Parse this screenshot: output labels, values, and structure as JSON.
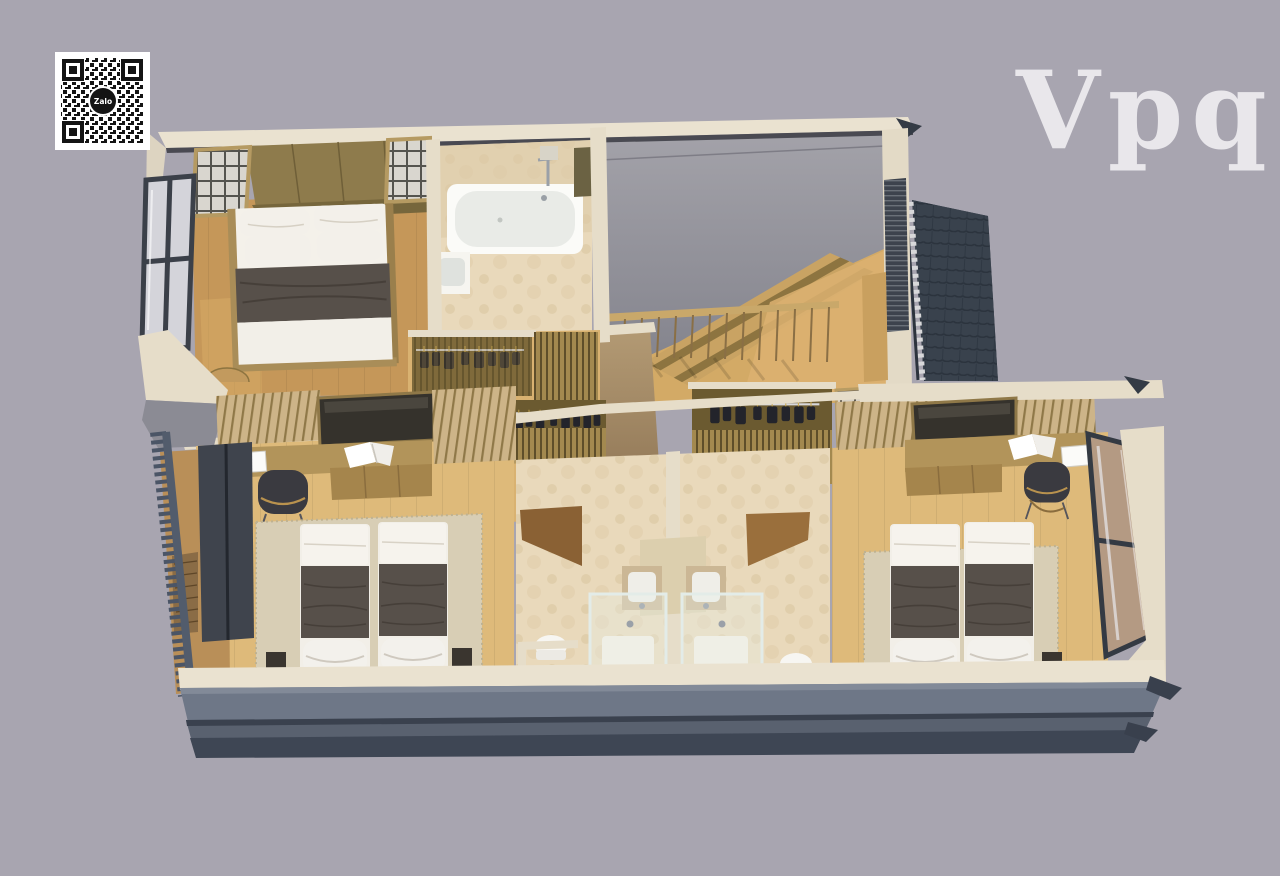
{
  "scene": {
    "type": "3d-isometric-floor-plan-render",
    "background_color": "#a8a5b0"
  },
  "watermark": {
    "text": "Vpq",
    "color": "#f2f1f4"
  },
  "qr_code": {
    "center_label": "Zalo",
    "foreground": "#141414",
    "background": "#ffffff"
  },
  "palette": {
    "background": "#a8a5b0",
    "wall_cream": "#eae2d0",
    "wall_trim": "#4a4a52",
    "floor_master": "#c59759",
    "floor_light": "#deba7a",
    "floor_stair": "#d3aa66",
    "bath_tile": "#e9d9bb",
    "headboard_wood": "#8e7b4c",
    "closet_gold": "#a3894f",
    "blanket_dark": "#57504a",
    "pillow_white": "#f3f0ea",
    "roof_tile": "#39424d",
    "facade_light": "#6e7787",
    "facade_mid": "#59616f",
    "facade_dark": "#3e4654",
    "railing_dark": "#4b5566",
    "glass_pale": "#d4d4da",
    "glass_warm": "#b49a83",
    "desk_wood": "#b2945a",
    "door_wood": "#8a6134",
    "chair_dark": "#3a3a40",
    "rug_beige": "#d8ceb5",
    "gray_wedge": "#96959d"
  }
}
